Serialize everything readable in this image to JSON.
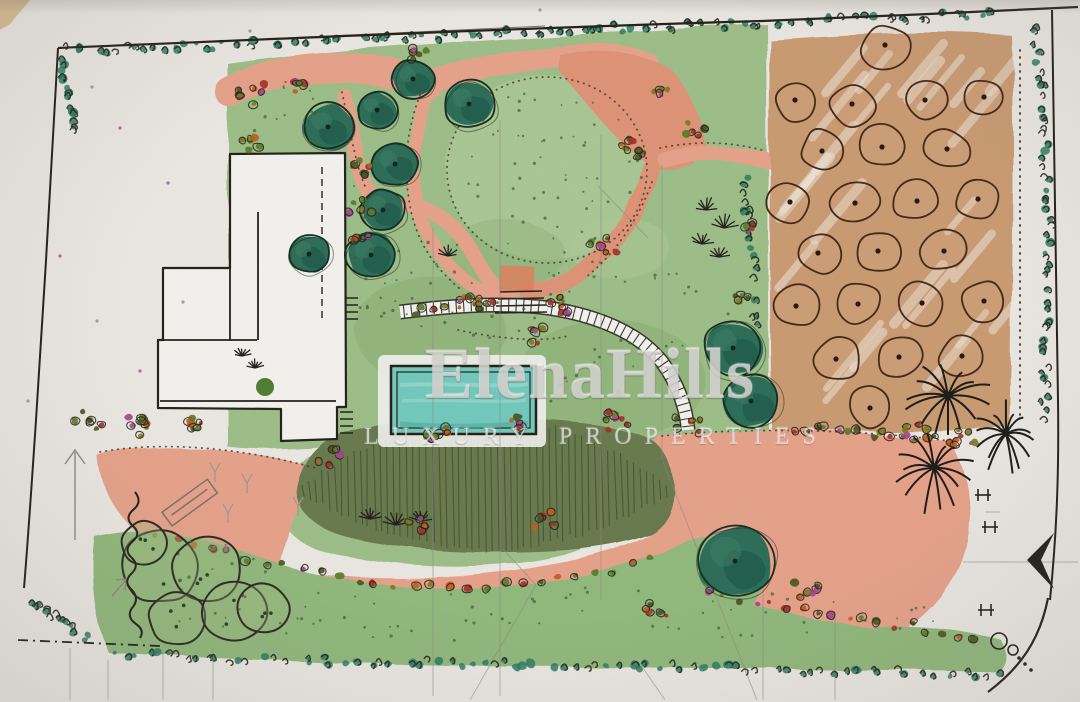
{
  "meta": {
    "title": "Hand-drawn landscape garden site plan (watercolor sketch)"
  },
  "watermark": {
    "brand": "ElenaHills",
    "tagline": "LUXURY PROPERTIES"
  },
  "palette": {
    "paper": "#e9e6e1",
    "paperLight": "#f1f0ed",
    "ink": "#24211b",
    "pencil": "#8a8780",
    "lawn": "#9cbd87",
    "lawnLight": "#abc795",
    "lawnDark": "#7fa468",
    "lawnBottom": "#90b77c",
    "salmon": "#e5a189",
    "salmonDeep": "#dd9277",
    "terracotta": "#d8825f",
    "tan": "#c89a72",
    "tanLight": "#d6ac83",
    "orchardInk": "#44291a",
    "treeTeal": "#2c6d58",
    "treeTealDark": "#1d5546",
    "treeTealHi": "#3d8066",
    "treeOutline": "#142e24",
    "hedge": "#2e7a63",
    "mound": "#68794e",
    "moundHatch": "#3e4d2b",
    "pool": "#72c7bb",
    "poolLight": "#9ad8cd",
    "poolDark": "#4da89b",
    "shrubRed": "#a33028",
    "shrubOrange": "#c05c1f",
    "shrubMagenta": "#a0468c",
    "shrubOlive": "#7d7a1f",
    "shrubDark": "#4a5520",
    "stipple": "#3f5c33",
    "cornerTan": "#d7bd92",
    "paperDotPurple": "#9c5090"
  },
  "scene": {
    "garden_trees": [
      {
        "x": 328,
        "y": 127,
        "r": 26
      },
      {
        "x": 377,
        "y": 110,
        "r": 20
      },
      {
        "x": 413,
        "y": 79,
        "r": 21
      },
      {
        "x": 469,
        "y": 104,
        "r": 26
      },
      {
        "x": 395,
        "y": 164,
        "r": 24
      },
      {
        "x": 383,
        "y": 210,
        "r": 23
      },
      {
        "x": 371,
        "y": 255,
        "r": 25
      },
      {
        "x": 309,
        "y": 254,
        "r": 21
      },
      {
        "x": 733,
        "y": 348,
        "r": 30
      },
      {
        "x": 751,
        "y": 401,
        "r": 29
      },
      {
        "x": 735,
        "y": 561,
        "r": 39
      }
    ],
    "orchard_trees": [
      {
        "x": 885,
        "y": 45,
        "r": 25
      },
      {
        "x": 795,
        "y": 100,
        "r": 23
      },
      {
        "x": 852,
        "y": 104,
        "r": 24
      },
      {
        "x": 925,
        "y": 100,
        "r": 23
      },
      {
        "x": 984,
        "y": 97,
        "r": 22
      },
      {
        "x": 822,
        "y": 151,
        "r": 24
      },
      {
        "x": 882,
        "y": 147,
        "r": 24
      },
      {
        "x": 947,
        "y": 149,
        "r": 24
      },
      {
        "x": 790,
        "y": 202,
        "r": 23
      },
      {
        "x": 855,
        "y": 203,
        "r": 24
      },
      {
        "x": 917,
        "y": 201,
        "r": 24
      },
      {
        "x": 978,
        "y": 199,
        "r": 22
      },
      {
        "x": 818,
        "y": 253,
        "r": 23
      },
      {
        "x": 878,
        "y": 251,
        "r": 24
      },
      {
        "x": 944,
        "y": 251,
        "r": 23
      },
      {
        "x": 796,
        "y": 306,
        "r": 23
      },
      {
        "x": 858,
        "y": 304,
        "r": 24
      },
      {
        "x": 922,
        "y": 303,
        "r": 24
      },
      {
        "x": 984,
        "y": 301,
        "r": 22
      },
      {
        "x": 836,
        "y": 359,
        "r": 24
      },
      {
        "x": 899,
        "y": 357,
        "r": 24
      },
      {
        "x": 962,
        "y": 356,
        "r": 23
      },
      {
        "x": 870,
        "y": 408,
        "r": 23
      }
    ],
    "sketch_tree_circles": [
      {
        "x": 160,
        "y": 567,
        "r": 40
      },
      {
        "x": 207,
        "y": 568,
        "r": 36
      },
      {
        "x": 178,
        "y": 618,
        "r": 30
      },
      {
        "x": 234,
        "y": 611,
        "r": 33
      },
      {
        "x": 263,
        "y": 608,
        "r": 27
      },
      {
        "x": 145,
        "y": 543,
        "r": 24
      }
    ],
    "palms": [
      {
        "x": 948,
        "y": 396,
        "s": 1.15
      },
      {
        "x": 1006,
        "y": 434,
        "s": 0.95
      },
      {
        "x": 934,
        "y": 468,
        "s": 1.0
      }
    ],
    "grass_tufts": [
      {
        "x": 706,
        "y": 210,
        "s": 1.0
      },
      {
        "x": 724,
        "y": 228,
        "s": 1.1
      },
      {
        "x": 702,
        "y": 244,
        "s": 0.9
      },
      {
        "x": 719,
        "y": 257,
        "s": 0.8
      },
      {
        "x": 448,
        "y": 256,
        "s": 0.8
      },
      {
        "x": 370,
        "y": 519,
        "s": 0.9
      },
      {
        "x": 396,
        "y": 525,
        "s": 1.0
      },
      {
        "x": 421,
        "y": 521,
        "s": 0.9
      },
      {
        "x": 242,
        "y": 356,
        "s": 0.7
      },
      {
        "x": 255,
        "y": 368,
        "s": 0.6
      }
    ],
    "shrub_clusters": [
      {
        "x": 252,
        "y": 95,
        "n": 7,
        "s": 16
      },
      {
        "x": 251,
        "y": 143,
        "n": 5,
        "s": 11
      },
      {
        "x": 300,
        "y": 85,
        "n": 5,
        "s": 12
      },
      {
        "x": 418,
        "y": 54,
        "n": 5,
        "s": 12
      },
      {
        "x": 358,
        "y": 168,
        "n": 6,
        "s": 12
      },
      {
        "x": 360,
        "y": 205,
        "n": 5,
        "s": 11
      },
      {
        "x": 363,
        "y": 236,
        "n": 5,
        "s": 11
      },
      {
        "x": 634,
        "y": 148,
        "n": 7,
        "s": 14
      },
      {
        "x": 694,
        "y": 128,
        "n": 6,
        "s": 13
      },
      {
        "x": 662,
        "y": 95,
        "n": 4,
        "s": 10
      },
      {
        "x": 604,
        "y": 247,
        "n": 6,
        "s": 13
      },
      {
        "x": 470,
        "y": 300,
        "n": 6,
        "s": 13
      },
      {
        "x": 556,
        "y": 306,
        "n": 6,
        "s": 13
      },
      {
        "x": 532,
        "y": 336,
        "n": 5,
        "s": 11
      },
      {
        "x": 145,
        "y": 422,
        "n": 8,
        "s": 20
      },
      {
        "x": 200,
        "y": 424,
        "n": 6,
        "s": 14
      },
      {
        "x": 90,
        "y": 420,
        "n": 6,
        "s": 16
      },
      {
        "x": 333,
        "y": 455,
        "n": 7,
        "s": 15
      },
      {
        "x": 437,
        "y": 432,
        "n": 6,
        "s": 14
      },
      {
        "x": 521,
        "y": 424,
        "n": 5,
        "s": 12
      },
      {
        "x": 617,
        "y": 420,
        "n": 7,
        "s": 14
      },
      {
        "x": 688,
        "y": 424,
        "n": 5,
        "s": 12
      },
      {
        "x": 545,
        "y": 520,
        "n": 5,
        "s": 12
      },
      {
        "x": 415,
        "y": 527,
        "n": 5,
        "s": 12
      },
      {
        "x": 805,
        "y": 588,
        "n": 6,
        "s": 14
      },
      {
        "x": 655,
        "y": 610,
        "n": 5,
        "s": 12
      },
      {
        "x": 968,
        "y": 440,
        "n": 6,
        "s": 14
      },
      {
        "x": 917,
        "y": 432,
        "n": 5,
        "s": 12
      },
      {
        "x": 744,
        "y": 300,
        "n": 4,
        "s": 9
      },
      {
        "x": 748,
        "y": 225,
        "n": 4,
        "s": 9
      }
    ],
    "shrub_lines": [
      {
        "pts": [
          [
            788,
            428
          ],
          [
            850,
            432
          ],
          [
            910,
            436
          ],
          [
            965,
            442
          ]
        ],
        "n": 16
      },
      {
        "pts": [
          [
            150,
            530
          ],
          [
            230,
            553
          ],
          [
            310,
            572
          ],
          [
            420,
            588
          ],
          [
            520,
            585
          ],
          [
            610,
            572
          ],
          [
            660,
            557
          ]
        ],
        "n": 28
      },
      {
        "pts": [
          [
            700,
            592
          ],
          [
            760,
            602
          ],
          [
            820,
            612
          ],
          [
            900,
            625
          ],
          [
            980,
            638
          ]
        ],
        "n": 18
      },
      {
        "pts": [
          [
            408,
            312
          ],
          [
            450,
            306
          ],
          [
            500,
            300
          ]
        ],
        "n": 8
      }
    ],
    "hedges": [
      {
        "pts": [
          [
            62,
            50
          ],
          [
            180,
            48
          ],
          [
            300,
            43
          ],
          [
            470,
            34
          ],
          [
            620,
            28
          ],
          [
            760,
            23
          ],
          [
            1008,
            14
          ]
        ],
        "n": 95,
        "w": 9
      },
      {
        "pts": [
          [
            1034,
            26
          ],
          [
            1044,
            120
          ],
          [
            1049,
            250
          ],
          [
            1043,
            420
          ]
        ],
        "n": 52,
        "w": 9
      },
      {
        "pts": [
          [
            110,
            655
          ],
          [
            300,
            660
          ],
          [
            520,
            664
          ],
          [
            760,
            668
          ],
          [
            1005,
            677
          ]
        ],
        "n": 85,
        "w": 9
      },
      {
        "pts": [
          [
            60,
            56
          ],
          [
            68,
            100
          ],
          [
            74,
            135
          ]
        ],
        "n": 14,
        "w": 8
      },
      {
        "pts": [
          [
            26,
            600
          ],
          [
            55,
            618
          ],
          [
            88,
            638
          ]
        ],
        "n": 16,
        "w": 10
      },
      {
        "pts": [
          [
            743,
            175
          ],
          [
            752,
            250
          ],
          [
            757,
            330
          ]
        ],
        "n": 22,
        "w": 8
      }
    ],
    "symbols": {
      "gates": [
        [
          983,
          495
        ],
        [
          990,
          527
        ],
        [
          986,
          610
        ]
      ],
      "paper_dots": [
        [
          168,
          183
        ],
        [
          92,
          87
        ],
        [
          183,
          302
        ],
        [
          140,
          371
        ],
        [
          28,
          401
        ],
        [
          97,
          321
        ],
        [
          60,
          256
        ],
        [
          250,
          31
        ],
        [
          540,
          10
        ],
        [
          120,
          128
        ]
      ]
    }
  }
}
